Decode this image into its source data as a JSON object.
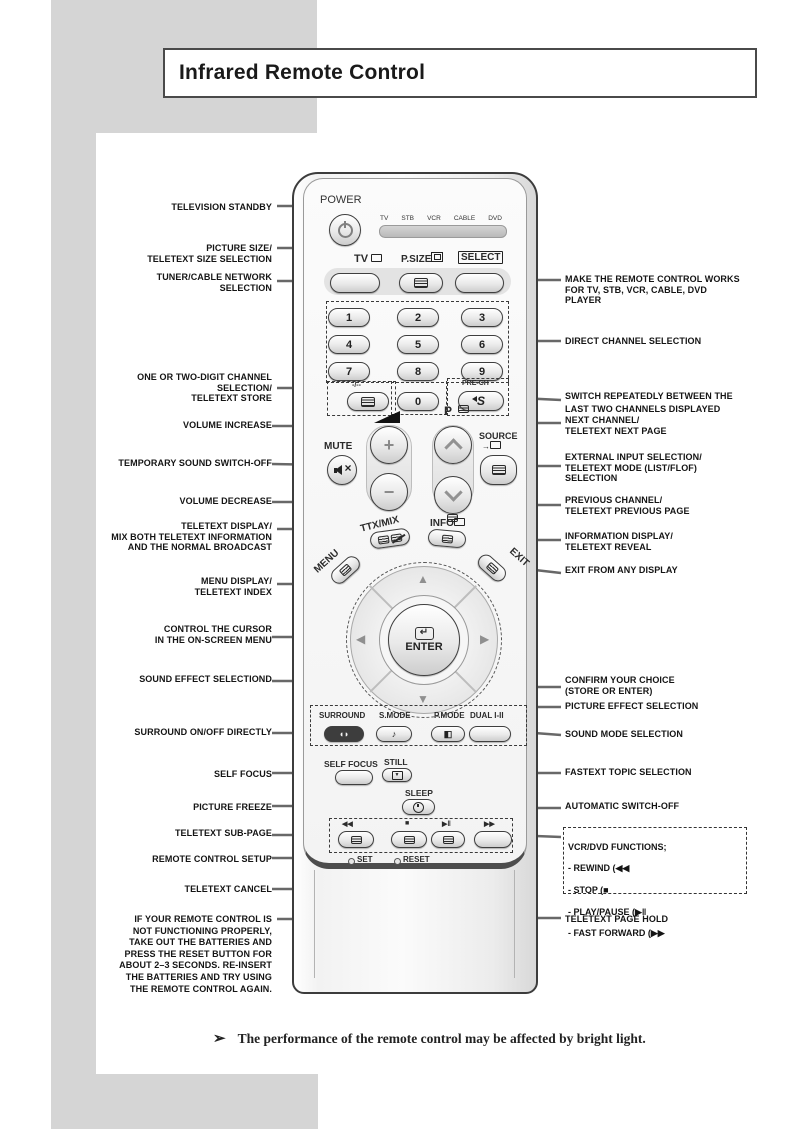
{
  "page": {
    "title": "Infrared Remote Control",
    "note_arrow": "➢",
    "note": "The performance of the remote control may be affected by bright light."
  },
  "remote": {
    "power_label": "POWER",
    "device_labels": [
      "TV",
      "STB",
      "VCR",
      "CABLE",
      "DVD"
    ],
    "tv_label": "TV",
    "psize_label": "P.SIZE",
    "select_label": "SELECT",
    "digits": [
      "1",
      "2",
      "3",
      "4",
      "5",
      "6",
      "7",
      "8",
      "9",
      "0"
    ],
    "one_two_digit_label": "-/--",
    "prech_label": "PRE-CH",
    "prech_glyph": "S",
    "volume_plus": "+",
    "volume_minus": "−",
    "mute_label": "MUTE",
    "p_label": "P",
    "source_label": "SOURCE",
    "source_arrow": "→",
    "ttx_mix_label": "TTX/MIX",
    "info_label": "INFO",
    "menu_label": "MENU",
    "exit_label": "EXIT",
    "enter_label": "ENTER",
    "enter_icon": "↵",
    "dpad_icons": {
      "up": "▲",
      "right": "▶",
      "down": "▼",
      "left": "◀"
    },
    "surround_label": "SURROUND",
    "surround_icon": "◖◗",
    "smode_label": "S.MODE",
    "smode_icon": "♪",
    "pmode_label": "P.MODE",
    "pmode_icon": "◧",
    "dual_label": "DUAL I-II",
    "selffocus_label": "SELF FOCUS",
    "still_label": "STILL",
    "still_icon": "▼",
    "sleep_label": "SLEEP",
    "vcr_symbols": [
      "◀◀",
      "■",
      "▶‖",
      "▶▶"
    ],
    "set_label": "SET",
    "reset_label": "RESET"
  },
  "left_labels": [
    "TELEVISION STANDBY",
    "PICTURE SIZE/\nTELETEXT SIZE SELECTION",
    "TUNER/CABLE NETWORK\nSELECTION",
    "ONE OR TWO-DIGIT CHANNEL\nSELECTION/\nTELETEXT STORE",
    "VOLUME INCREASE",
    "TEMPORARY SOUND SWITCH-OFF",
    "VOLUME DECREASE",
    "TELETEXT DISPLAY/\nMIX BOTH TELETEXT INFORMATION\nAND THE NORMAL BROADCAST",
    "MENU DISPLAY/\nTELETEXT INDEX",
    "CONTROL THE CURSOR\nIN THE ON-SCREEN MENU",
    "SOUND EFFECT SELECTIOND",
    "SURROUND ON/OFF DIRECTLY",
    "SELF FOCUS",
    "PICTURE FREEZE",
    "TELETEXT SUB-PAGE",
    "REMOTE CONTROL SETUP",
    "TELETEXT CANCEL",
    "IF YOUR REMOTE CONTROL IS\nNOT FUNCTIONING PROPERLY,\nTAKE OUT THE BATTERIES AND\nPRESS THE RESET BUTTON FOR\nABOUT 2–3 SECONDS. RE-INSERT\nTHE BATTERIES AND TRY  USING\nTHE REMOTE CONTROL AGAIN."
  ],
  "right_labels": [
    "MAKE THE REMOTE CONTROL WORKS\nFOR TV, STB, VCR, CABLE, DVD\nPLAYER",
    "DIRECT CHANNEL SELECTION",
    "SWITCH REPEATEDLY BETWEEN THE\nLAST TWO CHANNELS DISPLAYED",
    "NEXT CHANNEL/\nTELETEXT NEXT PAGE",
    "EXTERNAL INPUT SELECTION/\nTELETEXT MODE (LIST/FLOF)\nSELECTION",
    "PREVIOUS CHANNEL/\nTELETEXT PREVIOUS PAGE",
    "INFORMATION DISPLAY/\nTELETEXT REVEAL",
    "EXIT FROM ANY DISPLAY",
    "CONFIRM YOUR CHOICE\n(STORE OR ENTER)",
    "PICTURE EFFECT SELECTION",
    "SOUND MODE SELECTION",
    "FASTEXT TOPIC SELECTION",
    "AUTOMATIC SWITCH-OFF",
    "TELETEXT PAGE HOLD"
  ],
  "vcr_box": {
    "lines": [
      "VCR/DVD FUNCTIONS;",
      "- REWIND (◀◀",
      "- STOP (■",
      "- PLAY/PAUSE (▶‖",
      "- FAST FORWARD (▶▶"
    ]
  },
  "colors": {
    "page_gray": "#d5d5d5",
    "line_gray": "#686868",
    "remote_border": "#3c3c3c"
  }
}
